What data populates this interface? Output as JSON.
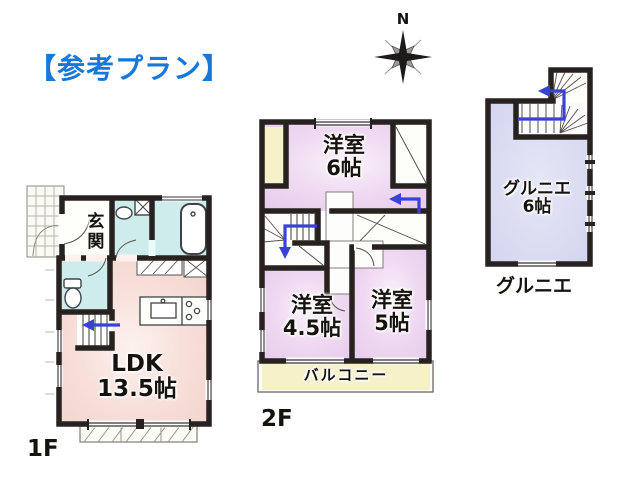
{
  "title": "【参考プラン】",
  "compass": {
    "north": "N"
  },
  "floor1": {
    "label": "1F",
    "entrance": "玄関",
    "ldk_name": "LDK",
    "ldk_size": "13.5帖"
  },
  "floor2": {
    "label": "2F",
    "room6_name": "洋室",
    "room6_size": "6帖",
    "room45_name": "洋室",
    "room45_size": "4.5帖",
    "room5_name": "洋室",
    "room5_size": "5帖",
    "balcony": "バルコニー"
  },
  "attic": {
    "label": "グルニエ",
    "room_name": "グルニエ",
    "room_size": "6帖"
  },
  "colors": {
    "title_blue": "#1878d8",
    "wall": "#272220",
    "ldk_pink": "#f5d8d3",
    "room_purple": "#e9cfee",
    "attic_lavender": "#d5d7ef",
    "wet_area_cyan": "#cdeceb",
    "closet_yellow": "#f6f1c8",
    "arrow_blue": "#3a41d6"
  }
}
